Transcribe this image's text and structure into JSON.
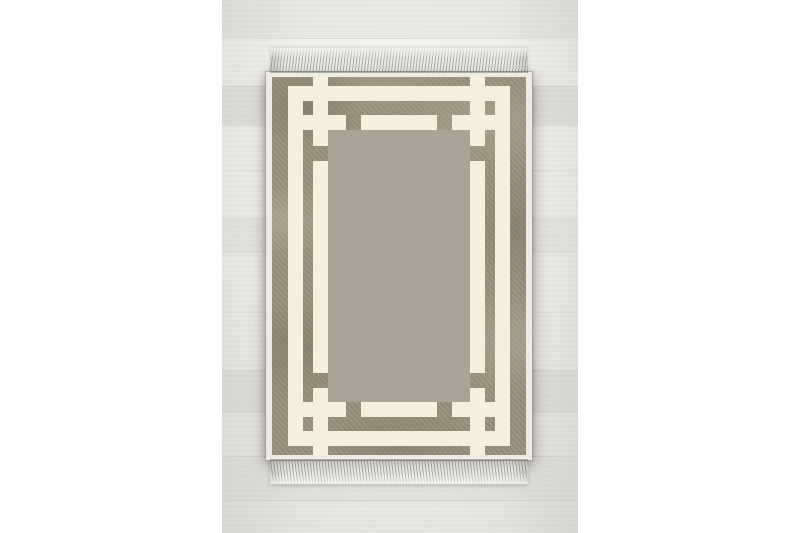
{
  "scene": {
    "type": "product-photo",
    "subject": "rectangular area rug with fringed short ends, laid on a whitewashed wooden plank floor, white canvas margins left and right",
    "canvas": {
      "width": 800,
      "height": 533,
      "background": "#ffffff"
    }
  },
  "photo": {
    "x": 222,
    "y": 0,
    "width": 356,
    "height": 533,
    "floor_light": "#f4f3f1",
    "floor_dark": "#ebeae7",
    "plank_lines_y": [
      38,
      86,
      125,
      170,
      218,
      252,
      312,
      370,
      412,
      456,
      500
    ],
    "plank_tints": [
      {
        "y": 0,
        "h": 38,
        "color": "rgba(196,194,188,0.22)"
      },
      {
        "y": 86,
        "h": 39,
        "color": "rgba(188,186,180,0.26)"
      },
      {
        "y": 218,
        "h": 34,
        "color": "rgba(202,200,194,0.20)"
      },
      {
        "y": 370,
        "h": 42,
        "color": "rgba(192,190,184,0.24)"
      },
      {
        "y": 456,
        "h": 44,
        "color": "rgba(200,198,192,0.18)"
      }
    ]
  },
  "rug": {
    "body": {
      "x": 266,
      "y": 72,
      "width": 266,
      "height": 388
    },
    "taupe": {
      "x": 272,
      "y": 77,
      "width": 254,
      "height": 378
    },
    "fringe_top": {
      "x": 270,
      "y": 48,
      "width": 258,
      "height": 24
    },
    "fringe_bottom": {
      "x": 270,
      "y": 460,
      "width": 258,
      "height": 24
    },
    "colors": {
      "binding": "#edebe4",
      "border_base": "#9a8f7b",
      "field": "#aba396",
      "cream": "#f7efde",
      "fringe": "#d7d6d3"
    },
    "pattern": {
      "description": "cream geometric border: double rectangular bands with interlocking Greek-key corner knots; bars pierce through to the fringed edges; small taupe squares at the weave crossings",
      "field_rect": [
        56,
        53,
        142,
        272
      ],
      "cream_rects": [
        [
          16,
          9,
          222,
          15
        ],
        [
          16,
          354,
          222,
          15
        ],
        [
          16,
          9,
          15,
          360
        ],
        [
          223,
          9,
          15,
          360
        ],
        [
          41,
          0,
          15,
          69
        ],
        [
          41,
          84,
          15,
          212
        ],
        [
          41,
          311,
          15,
          67
        ],
        [
          198,
          0,
          15,
          69
        ],
        [
          198,
          84,
          15,
          212
        ],
        [
          198,
          311,
          15,
          67
        ],
        [
          31,
          38,
          43,
          15
        ],
        [
          89,
          38,
          76,
          15
        ],
        [
          180,
          38,
          43,
          15
        ],
        [
          31,
          325,
          43,
          15
        ],
        [
          89,
          325,
          76,
          15
        ],
        [
          180,
          325,
          43,
          15
        ]
      ]
    }
  }
}
